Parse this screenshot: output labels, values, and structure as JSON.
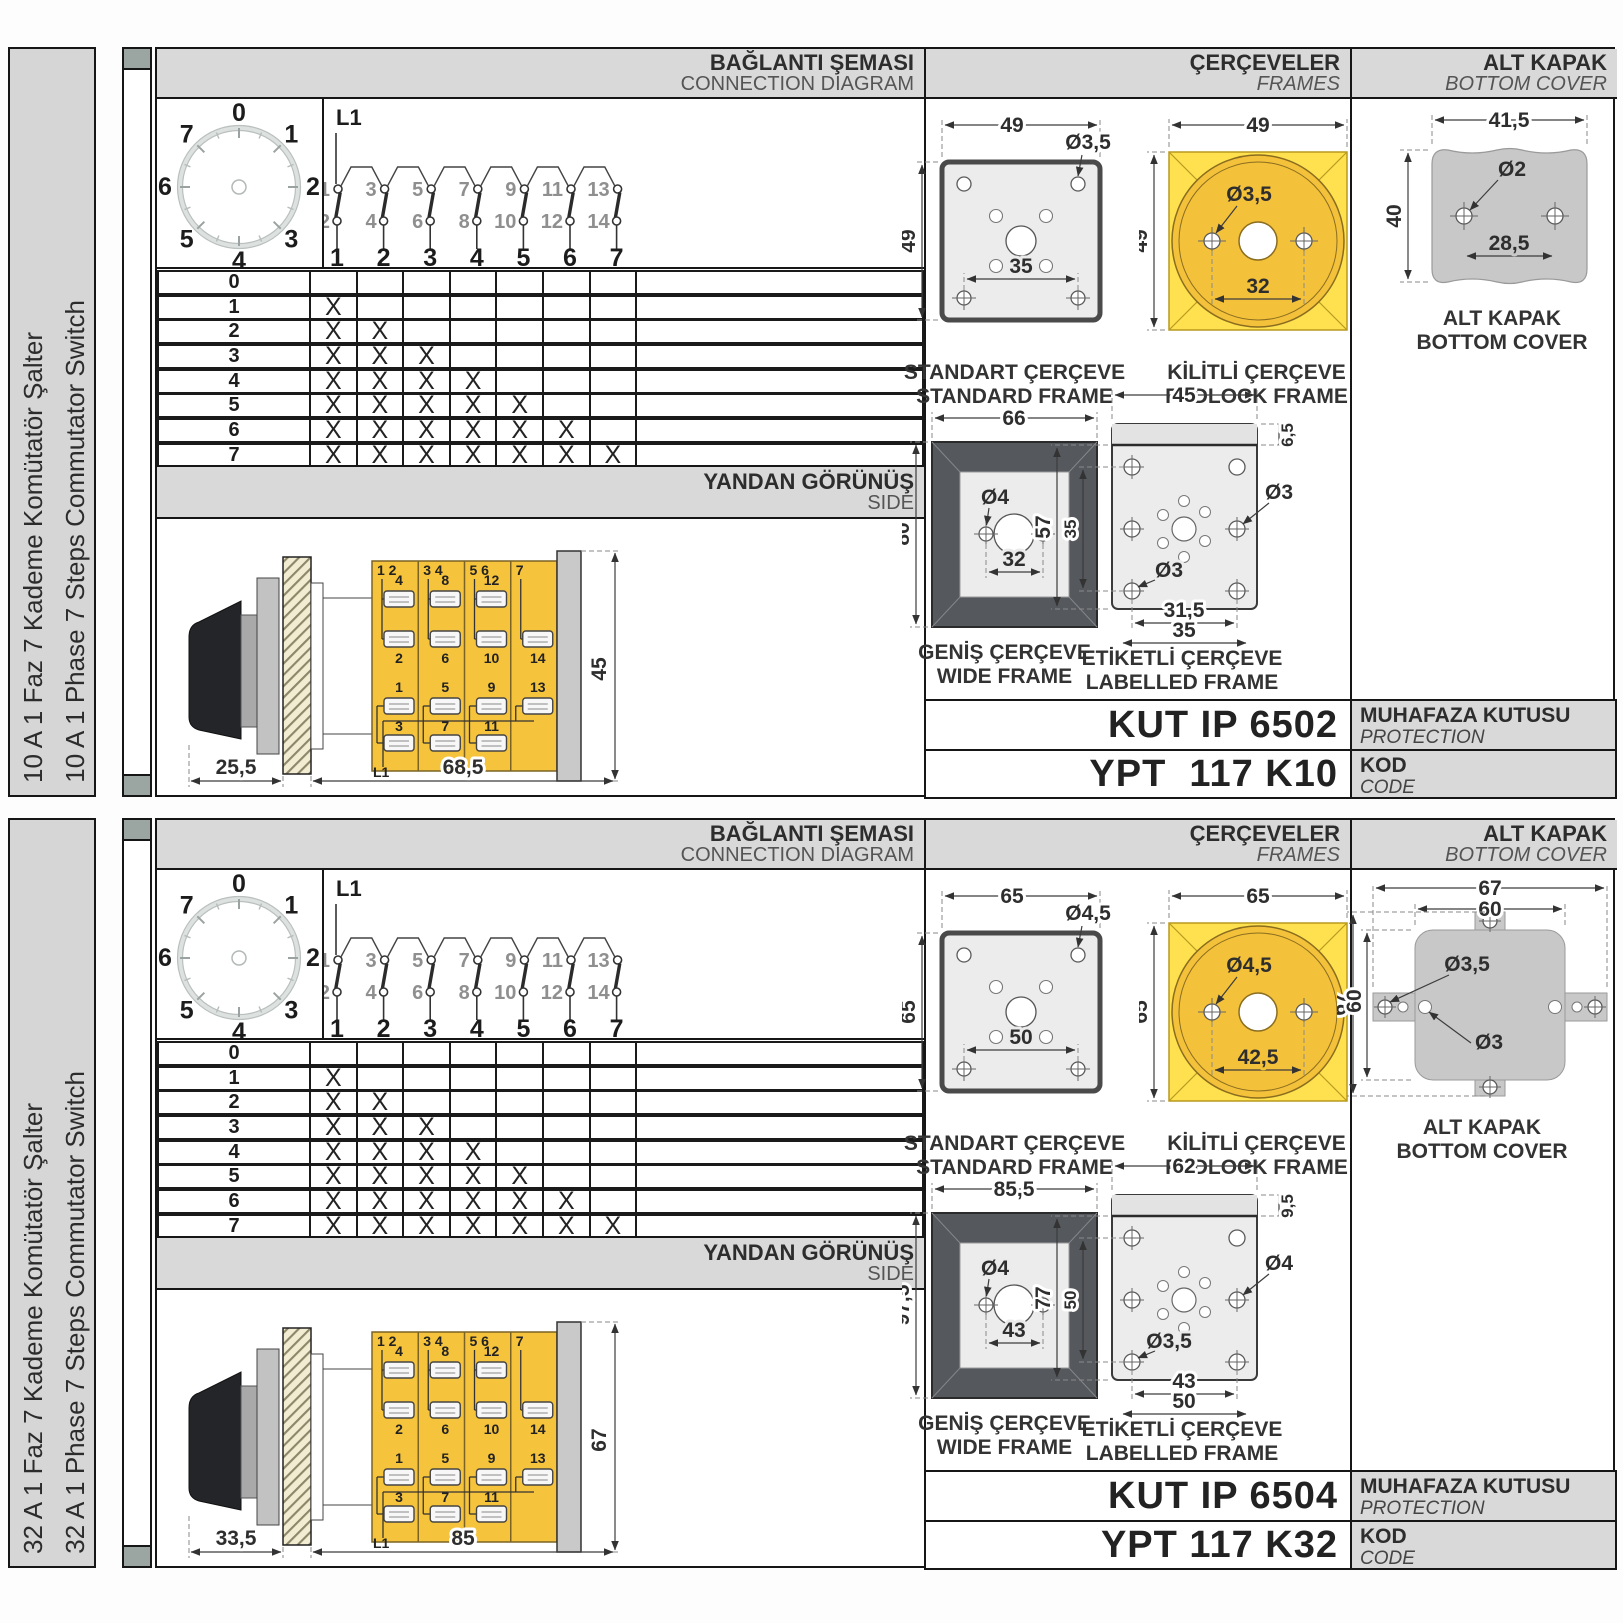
{
  "headers": {
    "connection_tr": "BAĞLANTI ŞEMASI",
    "connection_en": "CONNECTION DIAGRAM",
    "frames_tr": "ÇERÇEVELER",
    "frames_en": "FRAMES",
    "cover_tr": "ALT KAPAK",
    "cover_en": "BOTTOM COVER",
    "side_tr": "YANDAN GÖRÜNÜŞ",
    "side_en": "SIDE",
    "enclosure_tr": "MUHAFAZA KUTUSU",
    "enclosure_en": "PROTECTION ENCLOSURE",
    "code_tr": "KOD",
    "code_en": "CODE"
  },
  "frame_labels": {
    "standard_tr": "STANDART ÇERÇEVE",
    "standard_en": "STANDARD FRAME",
    "padlock_tr": "KİLİTLİ ÇERÇEVE",
    "padlock_en": "PADLOCK FRAME",
    "wide_tr": "GENİŞ ÇERÇEVE",
    "wide_en": "WIDE FRAME",
    "labelled_tr": "ETİKETLİ ÇERÇEVE",
    "labelled_en": "LABELLED FRAME",
    "cover_tr": "ALT KAPAK",
    "cover_en": "BOTTOM COVER"
  },
  "dial": {
    "positions": [
      "0",
      "1",
      "2",
      "3",
      "4",
      "5",
      "6",
      "7"
    ]
  },
  "diagram": {
    "line_label": "L1",
    "top_contacts": [
      "1",
      "3",
      "5",
      "7",
      "9",
      "11",
      "13"
    ],
    "bottom_contacts": [
      "2",
      "4",
      "6",
      "8",
      "10",
      "12",
      "14"
    ],
    "steps": [
      "1",
      "2",
      "3",
      "4",
      "5",
      "6",
      "7"
    ]
  },
  "table": {
    "row_labels": [
      "0",
      "1",
      "2",
      "3",
      "4",
      "5",
      "6",
      "7"
    ],
    "mark": "X",
    "matrix": [
      [
        0,
        0,
        0,
        0,
        0,
        0,
        0
      ],
      [
        1,
        0,
        0,
        0,
        0,
        0,
        0
      ],
      [
        1,
        1,
        0,
        0,
        0,
        0,
        0
      ],
      [
        1,
        1,
        1,
        0,
        0,
        0,
        0
      ],
      [
        1,
        1,
        1,
        1,
        0,
        0,
        0
      ],
      [
        1,
        1,
        1,
        1,
        1,
        0,
        0
      ],
      [
        1,
        1,
        1,
        1,
        1,
        1,
        0
      ],
      [
        1,
        1,
        1,
        1,
        1,
        1,
        1
      ]
    ]
  },
  "side_view": {
    "pair_labels": [
      "1 2",
      "3 4",
      "5 6",
      "7"
    ],
    "upper_terminal_labels": [
      "4",
      "8",
      "12"
    ],
    "lower_terminal_labels": [
      "2",
      "6",
      "10",
      "14"
    ],
    "mid_terminal_labels": [
      "1",
      "5",
      "9",
      "13"
    ],
    "bottom_terminal_labels": [
      "3",
      "7",
      "11"
    ],
    "line_label": "L1"
  },
  "colors": {
    "body_yellow": "#F5C33C",
    "padlock_yellow": "#FFE14F",
    "padlock_circle": "#F4C13B",
    "frame_gray": "#ececec",
    "wide_dark": "#55585d",
    "cover_gray": "#c8c8c8",
    "header_gray": "#d9d9d9"
  },
  "panels": [
    {
      "title_tr": "10 A 1 Faz 7 Kademe Komütatör Şalter",
      "title_en": "10 A 1 Phase 7 Steps Commutator Switch",
      "side_dims": {
        "front": "25,5",
        "body": "68,5",
        "height": "45"
      },
      "standard": {
        "w": "49",
        "h": "49",
        "hole": "Ø3,5",
        "pitch": "35"
      },
      "padlock": {
        "w": "49",
        "h": "49",
        "hole": "Ø3,5",
        "pitch": "32"
      },
      "wide": {
        "w": "66",
        "h": "80",
        "hole": "Ø4",
        "pitch": "32"
      },
      "labelled": {
        "w": "45",
        "band": "6,5",
        "h": "57",
        "inner_h": "35",
        "hole_top": "Ø3",
        "hole_bottom": "Ø3",
        "pitch_inner": "31,5",
        "pitch_outer": "35"
      },
      "cover": {
        "w": "41,5",
        "h": "40",
        "hole": "Ø2",
        "pitch": "28,5"
      },
      "enclosure_code": "KUT IP 6502",
      "product_code": "YPT  117 K10"
    },
    {
      "title_tr": "32 A 1 Faz 7 Kademe Komütatör Şalter",
      "title_en": "32 A 1 Phase 7 Steps Commutator Switch",
      "side_dims": {
        "front": "33,5",
        "body": "85",
        "height": "67"
      },
      "standard": {
        "w": "65",
        "h": "65",
        "hole": "Ø4,5",
        "pitch": "50"
      },
      "padlock": {
        "w": "65",
        "h": "65",
        "hole": "Ø4,5",
        "pitch": "42,5"
      },
      "wide": {
        "w": "85,5",
        "h": "97,5",
        "hole": "Ø4",
        "pitch": "43"
      },
      "labelled": {
        "w": "62",
        "band": "9,5",
        "h": "77",
        "inner_h": "50",
        "hole_top": "Ø4",
        "hole_bottom": "Ø3,5",
        "pitch_inner": "43",
        "pitch_outer": "50"
      },
      "cover": {
        "w_outer": "67",
        "w_inner": "60",
        "h_outer": "67",
        "h_inner": "60",
        "hole_tab": "Ø3,5",
        "hole_body": "Ø3"
      },
      "enclosure_code": "KUT IP 6504",
      "product_code": "YPT 117 K32"
    }
  ]
}
